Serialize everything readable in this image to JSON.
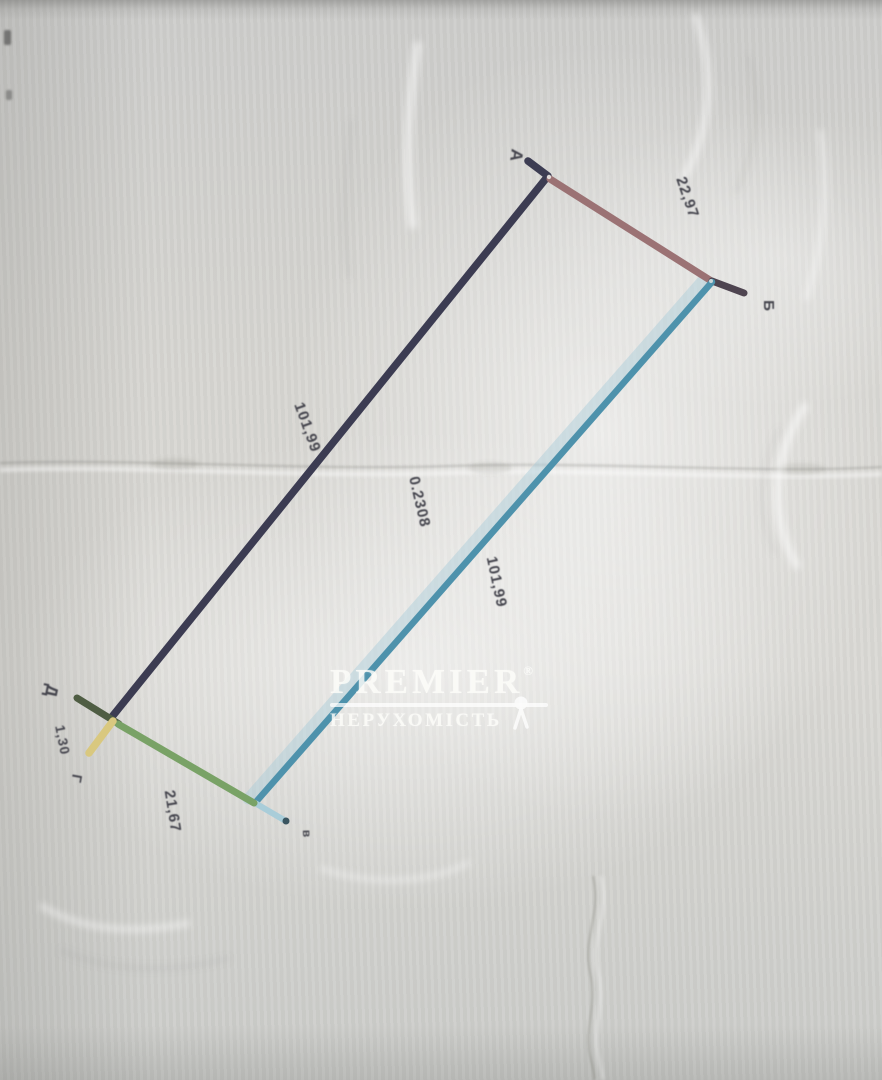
{
  "plan": {
    "type": "land-parcel-boundary-survey",
    "area_label": "0.2308",
    "point_labels": {
      "a": "А",
      "b": "Б",
      "v": "в",
      "g": "Г",
      "d": "Д"
    },
    "segment_labels": {
      "ab": "22,97",
      "bv": "101,99",
      "vg": "21,67",
      "gd": "1,30",
      "da": "101,99"
    },
    "segments": [
      {
        "from": "А",
        "to": "Б",
        "length_m": "22,97"
      },
      {
        "from": "Б",
        "to": "В",
        "length_m": "101,99"
      },
      {
        "from": "В",
        "to": "Г",
        "length_m": "21,67"
      },
      {
        "from": "Г",
        "to": "Д",
        "length_m": "1,30"
      },
      {
        "from": "Д",
        "to": "А",
        "length_m": "101,99"
      }
    ]
  },
  "watermark": {
    "brand": "PREMIER",
    "reg": "®",
    "subtitle": "НЕРУХОМІСТЬ"
  },
  "colors": {
    "navy": "#3c3c52",
    "rose": "#9b7274",
    "rose_tip": "#4e4450",
    "teal": "#4e92ac",
    "teal_light": "#a9cdd9",
    "teal_tip": "#3a5560",
    "green": "#79a266",
    "green_dark": "#4f5d43",
    "yellow": "#d9c87f",
    "label": "#45454e",
    "watermark": "#ffffff"
  }
}
